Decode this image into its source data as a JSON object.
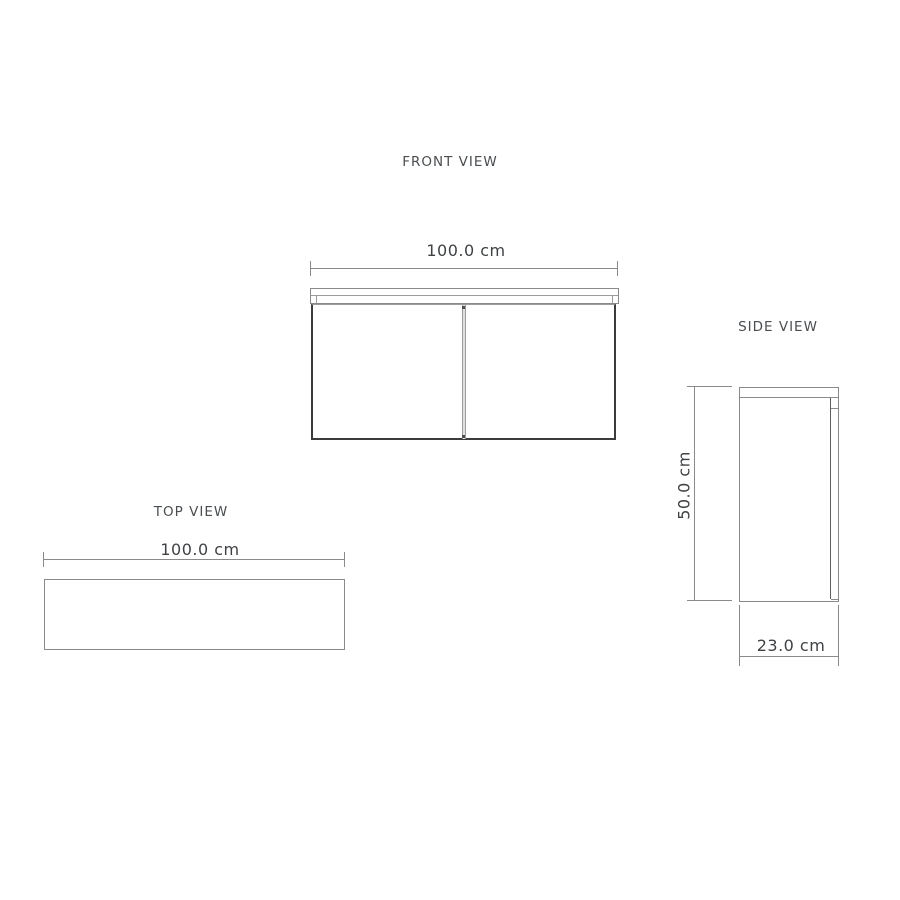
{
  "drawing": {
    "front": {
      "title": "FRONT VIEW",
      "width_dim": "100.0 cm"
    },
    "side": {
      "title": "SIDE VIEW",
      "height_dim": "50.0 cm",
      "depth_dim": "23.0 cm"
    },
    "top": {
      "title": "TOP VIEW",
      "width_dim": "100.0 cm"
    }
  },
  "colors": {
    "background": "#ffffff",
    "dimension_line": "#8a8a8a",
    "light_edge": "#9c9c9c",
    "door_outline": "#3c3c3c",
    "door_edge_dark": "#5f5f5f",
    "title_text": "#4a4e51",
    "dim_text": "#3f4244",
    "divider_fill": "#e0e0e0"
  }
}
